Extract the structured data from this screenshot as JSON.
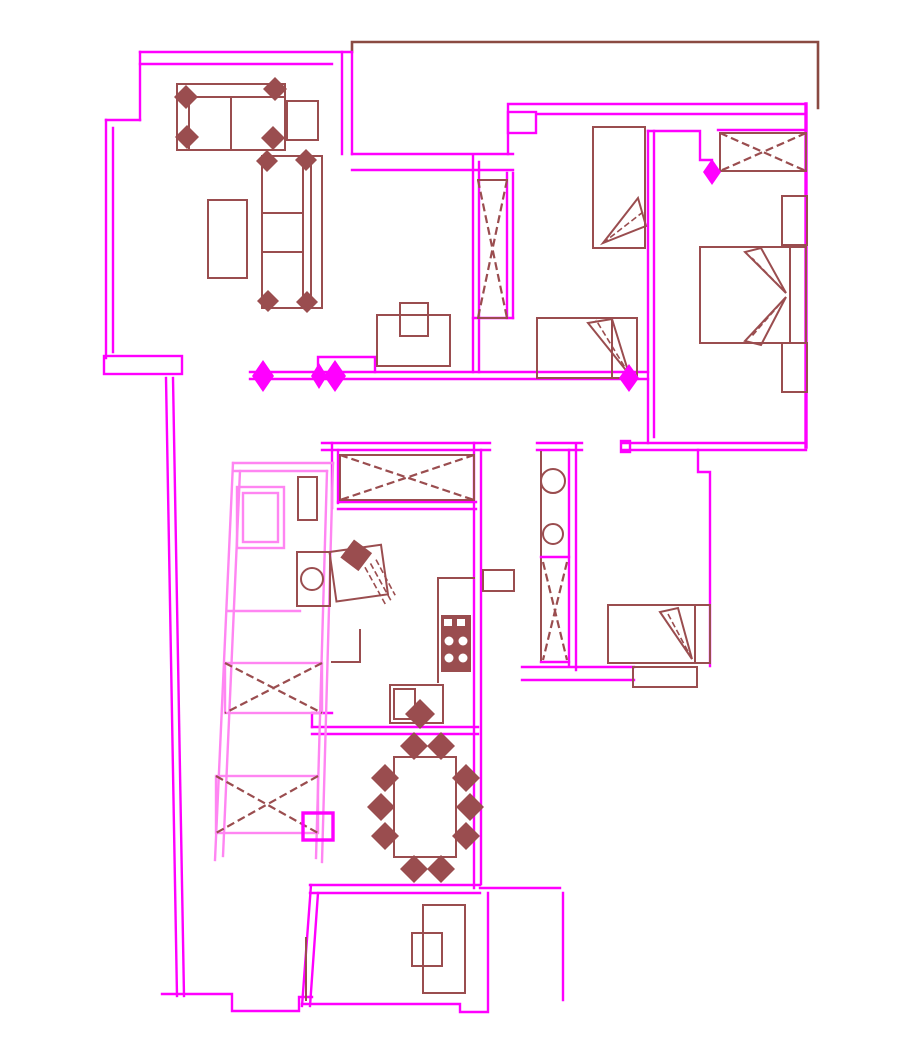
{
  "document": {
    "label": "Residential apartment floor plan (CAD line drawing, no visible text)"
  },
  "palette": {
    "background": "#ffffff",
    "wall_primary": "#ff00ff",
    "wall_light": "#ff85f2",
    "furniture": "#9a4d4f",
    "balcony_outline": "#8a4a42",
    "door_marker": "#ff00ff"
  },
  "rooms": [
    {
      "id": "living-room",
      "furniture": [
        "large-sofa",
        "chaise-sofa",
        "side-table",
        "coffee-table",
        "tv-cabinet"
      ]
    },
    {
      "id": "bedroom-top-middle",
      "furniture": [
        "single-bed-vertical",
        "single-bed-horizontal",
        "tall-closet-x"
      ]
    },
    {
      "id": "bedroom-top-right",
      "furniture": [
        "wardrobe-x",
        "double-bed",
        "nightstand",
        "nightstand"
      ]
    },
    {
      "id": "balcony-top",
      "furniture": []
    },
    {
      "id": "bathroom-left-slanted",
      "furniture": [
        "shower-cabin",
        "radiator",
        "washbasin",
        "storage-x",
        "storage-x"
      ]
    },
    {
      "id": "kitchen",
      "furniture": [
        "wardrobe-x",
        "counter",
        "stove-4-burner",
        "sink-cabinet",
        "desk-chair"
      ]
    },
    {
      "id": "wc-duct-column",
      "furniture": [
        "toilet",
        "sink",
        "duct-x"
      ]
    },
    {
      "id": "bedroom-lower-right",
      "furniture": [
        "single-bed",
        "shelf"
      ]
    },
    {
      "id": "dining-area",
      "furniture": [
        "dining-table",
        "chairs"
      ]
    },
    {
      "id": "study-bottom",
      "furniture": [
        "desk",
        "chair"
      ]
    },
    {
      "id": "hallway",
      "furniture": [
        "small-shelf"
      ]
    }
  ],
  "counts": {
    "door_markers": 5,
    "dining_chairs": 10,
    "x_storage_units": 6,
    "beds": 5
  }
}
